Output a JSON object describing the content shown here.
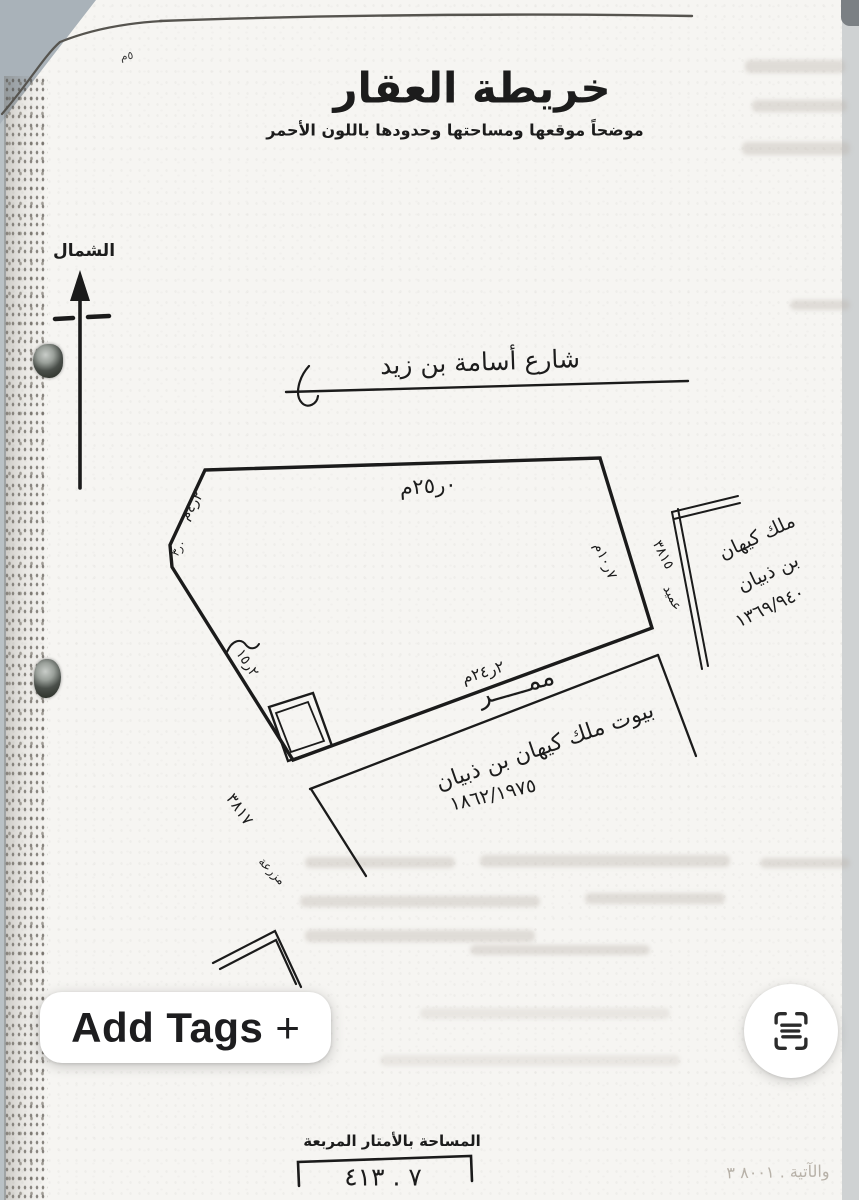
{
  "document": {
    "corner_mark": "٥م",
    "title": "خريطة العقار",
    "subtitle": "موضحاً موقعها ومساحتها وحدودها باللون الأحمر",
    "north_label": "الشمال",
    "north_icon": "north-arrow-icon",
    "street_label": "شارع أسامة بن زيد",
    "measurements": {
      "top_edge": "م٢٥ر٠",
      "upper_left_edge": "م٤ر٢",
      "left_small": "٣ر٠",
      "left_edge": "١٥ر٢",
      "right_edge": "م١٠ر٧",
      "bottom_edge": "م٢٤ر٢"
    },
    "passage_label": "ممـــــر",
    "right_neighbor": {
      "line1": "ملك كيهان",
      "line2": "بن ذبيان",
      "deed": "١٣٦٩/٩٤٠"
    },
    "bottom_neighbor": {
      "line1": "بيوت ملك كيهان بن ذبيان",
      "deed": "١٨٦٢/١٩٧٥"
    },
    "left_margin_number": "٣٨١٧",
    "left_margin_word": "مزرعة",
    "right_margin_number": "٣٨١٥",
    "right_margin_word": "عميد",
    "area_label": "المساحة بالأمتار المربعة",
    "area_value": "٤١٣ . ٧",
    "stamp": "والآتية . ٨٠٠١ ٣"
  },
  "ui": {
    "add_tags_label": "Add Tags",
    "add_tags_plus": "+",
    "scan_icon": "scan-text-icon"
  },
  "colors": {
    "ink": "#1b1b1b",
    "paper": "#f6f5f2",
    "photo_background": "#cfd2d3",
    "button_text": "#1d1d1f"
  }
}
